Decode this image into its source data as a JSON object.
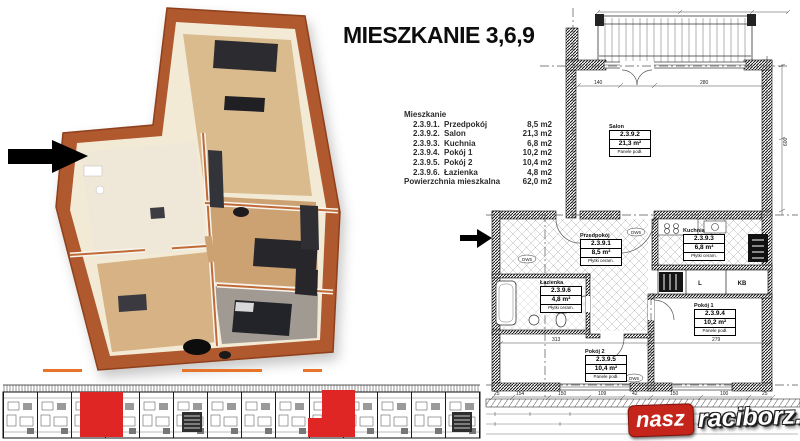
{
  "title": "MIESZKANIE 3,6,9",
  "room_table": {
    "header": "Mieszkanie",
    "rows": [
      {
        "code": "2.3.9.1.",
        "name": "Przedpokój",
        "area": "8,5 m2"
      },
      {
        "code": "2.3.9.2.",
        "name": "Salon",
        "area": "21,3 m2"
      },
      {
        "code": "2.3.9.3.",
        "name": "Kuchnia",
        "area": "6,8 m2"
      },
      {
        "code": "2.3.9.4.",
        "name": "Pokój 1",
        "area": "10,2 m2"
      },
      {
        "code": "2.3.9.5.",
        "name": "Pokój 2",
        "area": "10,4 m2"
      },
      {
        "code": "2.3.9.6.",
        "name": "Łazienka",
        "area": "4,8 m2"
      }
    ],
    "total_label": "Powierzchnia mieszkalna",
    "total_area": "62,0 m2"
  },
  "plan_labels": {
    "salon": {
      "name": "Salon",
      "code": "2.3.9.2",
      "area": "21,3 m²",
      "floor": "Panele podł."
    },
    "przedpokoj": {
      "name": "Przedpokój",
      "code": "2.3.9.1",
      "area": "8,5 m²",
      "floor": "Płytki ceram."
    },
    "kuchnia": {
      "name": "Kuchnia",
      "code": "2.3.9.3",
      "area": "6,8 m²",
      "floor": "Płytki ceram."
    },
    "lazienka": {
      "name": "Łazienka",
      "code": "2.3.9.6",
      "area": "4,8 m²",
      "floor": "Płytki ceram."
    },
    "pokoj1": {
      "name": "Pokój 1",
      "code": "2.3.9.4",
      "area": "10,2 m²",
      "floor": "Panele podł."
    },
    "pokoj2": {
      "name": "Pokój 2",
      "code": "2.3.9.5",
      "area": "10,4 m²",
      "floor": "Panele podł."
    }
  },
  "plan_annotations": {
    "closet_l": "L",
    "closet_kb": "KB",
    "door_a": "DW6",
    "door_b": "DW5",
    "door_c": "DW6"
  },
  "plan_dims": {
    "d140": "140",
    "d280": "280",
    "d600": "600",
    "d313": "313",
    "d279": "279",
    "bottom_row": [
      "25",
      "154",
      "150",
      "109",
      "42",
      "150",
      "100",
      "25"
    ]
  },
  "logo": {
    "nasz": "nasz",
    "raciborz": "raciborz.pl"
  },
  "colors": {
    "highlight_red": "#e02525",
    "balcony_orange": "#e8732a",
    "brick": "#b0592e",
    "logo_red": "#c5241b"
  }
}
